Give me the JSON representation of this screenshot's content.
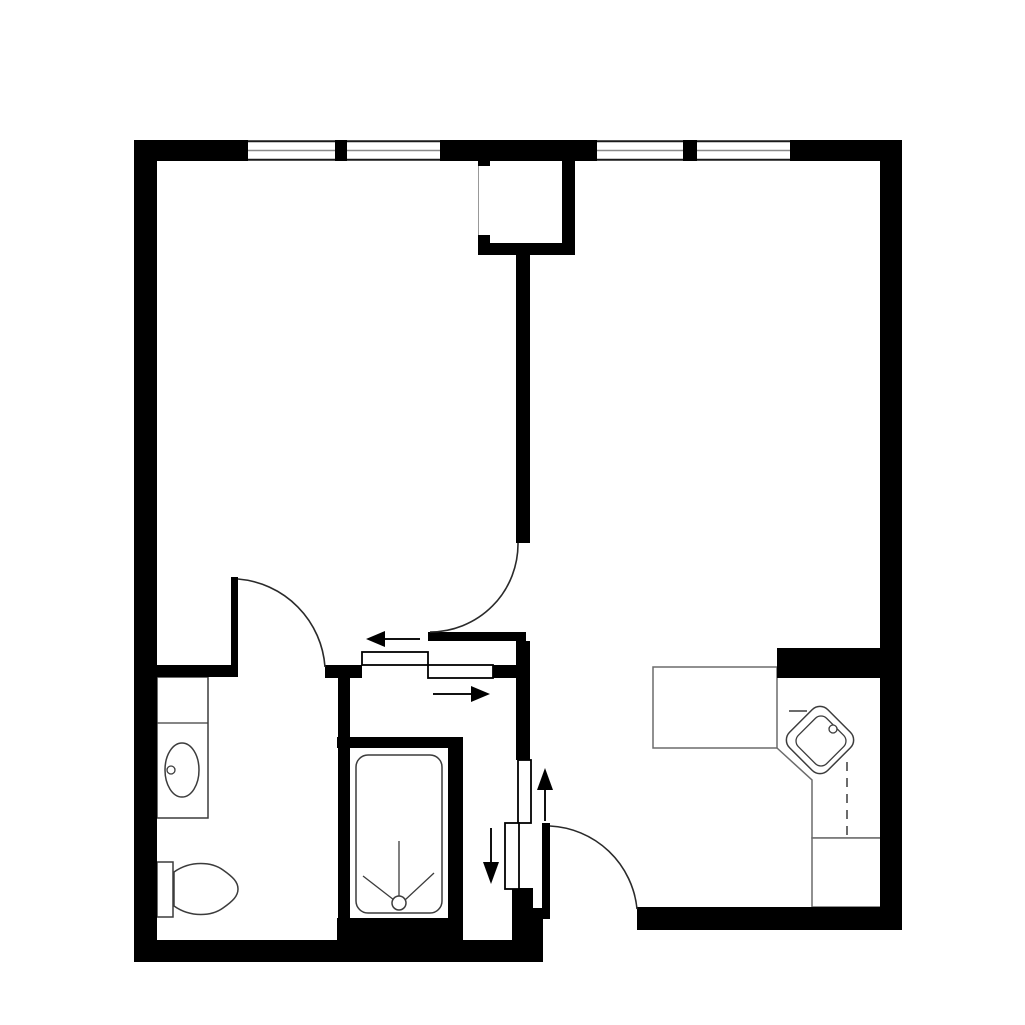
{
  "canvas": {
    "w": 1025,
    "h": 1025,
    "bg": "#ffffff"
  },
  "palette": {
    "wall": "#000000",
    "fixture": "#3c3c3c",
    "counter": "#6b6b6b",
    "window_mid": "#8a8a8a",
    "window_edge": "#1a1a1a",
    "arc": "#2a2a2a",
    "arrow": "#111111",
    "shaft_line": "#999999",
    "floor": "#ffffff"
  },
  "walls": [
    {
      "n": "top-wall-left",
      "x": 134,
      "y": 140,
      "w": 114,
      "h": 21
    },
    {
      "n": "window-mullion-1",
      "x": 335,
      "y": 140,
      "w": 12,
      "h": 21
    },
    {
      "n": "top-wall-center",
      "x": 440,
      "y": 140,
      "w": 157,
      "h": 21
    },
    {
      "n": "window-mullion-2",
      "x": 683,
      "y": 140,
      "w": 14,
      "h": 21
    },
    {
      "n": "top-wall-right",
      "x": 790,
      "y": 140,
      "w": 112,
      "h": 21
    },
    {
      "n": "left-wall",
      "x": 134,
      "y": 140,
      "w": 23,
      "h": 822
    },
    {
      "n": "right-wall",
      "x": 880,
      "y": 140,
      "w": 22,
      "h": 790
    },
    {
      "n": "shaft-right-wall",
      "x": 562,
      "y": 158,
      "w": 13,
      "h": 97
    },
    {
      "n": "shaft-bottom-wall",
      "x": 478,
      "y": 243,
      "w": 97,
      "h": 12
    },
    {
      "n": "shaft-notch-top",
      "x": 478,
      "y": 158,
      "w": 12,
      "h": 8
    },
    {
      "n": "shaft-notch-bottom",
      "x": 478,
      "y": 235,
      "w": 12,
      "h": 8
    },
    {
      "n": "room-divider-wall",
      "x": 516,
      "y": 255,
      "w": 14,
      "h": 288
    },
    {
      "n": "hall-top-wall",
      "x": 428,
      "y": 632,
      "w": 98,
      "h": 9
    },
    {
      "n": "hall-vertical-wall",
      "x": 516,
      "y": 641,
      "w": 14,
      "h": 119
    },
    {
      "n": "bath-top-wall",
      "x": 134,
      "y": 665,
      "w": 98,
      "h": 12
    },
    {
      "n": "bath-door-jamb-wall",
      "x": 325,
      "y": 665,
      "w": 37,
      "h": 13
    },
    {
      "n": "slide-door-right-wall",
      "x": 493,
      "y": 665,
      "w": 23,
      "h": 13
    },
    {
      "n": "bath-right-wall",
      "x": 338,
      "y": 677,
      "w": 12,
      "h": 62
    },
    {
      "n": "shower-top-wall",
      "x": 337,
      "y": 737,
      "w": 126,
      "h": 11
    },
    {
      "n": "shower-left-wall",
      "x": 338,
      "y": 748,
      "w": 12,
      "h": 192
    },
    {
      "n": "shower-right-wall",
      "x": 448,
      "y": 748,
      "w": 15,
      "h": 175
    },
    {
      "n": "shower-bottom-wall",
      "x": 337,
      "y": 918,
      "w": 126,
      "h": 24
    },
    {
      "n": "bottom-wall-left",
      "x": 134,
      "y": 940,
      "w": 409,
      "h": 22
    },
    {
      "n": "entry-step-wall-a",
      "x": 512,
      "y": 888,
      "w": 21,
      "h": 22
    },
    {
      "n": "entry-step-wall-b",
      "x": 512,
      "y": 908,
      "w": 31,
      "h": 34
    },
    {
      "n": "bottom-wall-right",
      "x": 637,
      "y": 907,
      "w": 265,
      "h": 23
    },
    {
      "n": "kitchen-wall-stub",
      "x": 777,
      "y": 648,
      "w": 105,
      "h": 30
    },
    {
      "n": "bath-door-leaf",
      "x": 231,
      "y": 577,
      "w": 7,
      "h": 100
    },
    {
      "n": "entry-door-leaf",
      "x": 542,
      "y": 823,
      "w": 8,
      "h": 96
    }
  ],
  "windows": [
    {
      "n": "window-1",
      "x": 248,
      "y": 140,
      "w": 87,
      "h": 21
    },
    {
      "n": "window-2",
      "x": 347,
      "y": 140,
      "w": 93,
      "h": 21
    },
    {
      "n": "window-3",
      "x": 597,
      "y": 140,
      "w": 86,
      "h": 21
    },
    {
      "n": "window-4",
      "x": 697,
      "y": 140,
      "w": 93,
      "h": 21
    }
  ],
  "sliding_panels": [
    {
      "n": "slide-panel-upper",
      "x": 362,
      "y": 652,
      "w": 66,
      "h": 13
    },
    {
      "n": "slide-panel-lower",
      "x": 428,
      "y": 665,
      "w": 65,
      "h": 13
    },
    {
      "n": "slide-panel-vert-right",
      "x": 518,
      "y": 760,
      "w": 13,
      "h": 63
    },
    {
      "n": "slide-panel-vert-left",
      "x": 505,
      "y": 823,
      "w": 14,
      "h": 66
    }
  ],
  "door_arcs": [
    {
      "n": "center-door-swing-arc",
      "d": "M518,543 A88,88 0 0 1 430,632"
    },
    {
      "n": "bath-door-swing-arc",
      "d": "M238,579 A95,95 0 0 1 325,667"
    },
    {
      "n": "entry-door-swing-arc",
      "d": "M550,826 A92,92 0 0 1 637,909"
    }
  ],
  "arrows": [
    {
      "n": "slide-arrow-left",
      "line": [
        420,
        639,
        384,
        639
      ],
      "head": "366,639 385,631 385,647"
    },
    {
      "n": "slide-arrow-right",
      "line": [
        433,
        694,
        471,
        694
      ],
      "head": "490,694 471,686 471,702"
    },
    {
      "n": "slide-arrow-up",
      "line": [
        545,
        821,
        545,
        789
      ],
      "head": "545,768 537,790 553,790"
    },
    {
      "n": "slide-arrow-down",
      "line": [
        491,
        828,
        491,
        862
      ],
      "head": "491,884 483,862 499,862"
    }
  ],
  "fixtures": [
    {
      "t": "line",
      "n": "shaft-inner-line",
      "x1": 478.5,
      "y1": 166,
      "x2": 478.5,
      "y2": 235,
      "s": "shaft_line",
      "sw": 1
    },
    {
      "t": "rect",
      "n": "vanity-counter",
      "x": 157,
      "y": 677,
      "w": 51,
      "h": 141,
      "s": "fixture",
      "sw": 1.5,
      "f": "#ffffff"
    },
    {
      "t": "line",
      "n": "vanity-divider-line",
      "x1": 157,
      "y1": 723,
      "x2": 208,
      "y2": 723,
      "s": "fixture",
      "sw": 1.3
    },
    {
      "t": "ellipse",
      "n": "bathroom-sink",
      "cx": 182,
      "cy": 770,
      "rx": 17,
      "ry": 27,
      "s": "fixture",
      "sw": 1.5,
      "f": "#ffffff"
    },
    {
      "t": "circle",
      "n": "bathroom-sink-drain",
      "cx": 171,
      "cy": 770,
      "r": 4,
      "s": "fixture",
      "sw": 1.3,
      "f": "#ffffff"
    },
    {
      "t": "rect",
      "n": "toilet-tank",
      "x": 157,
      "y": 862,
      "w": 16,
      "h": 55,
      "s": "fixture",
      "sw": 1.5,
      "f": "#ffffff"
    },
    {
      "t": "path",
      "n": "toilet-bowl",
      "d": "M174,872 C191,860 212,862 223,870 C233,877 238,882 238,889 C238,896 233,901 223,908 C212,916 191,918 174,906 Z",
      "s": "fixture",
      "sw": 1.5,
      "f": "#ffffff"
    },
    {
      "t": "rect",
      "n": "shower-tray",
      "x": 356,
      "y": 755,
      "w": 86,
      "h": 158,
      "rx": 12,
      "s": "fixture",
      "sw": 1.5,
      "f": "#ffffff"
    },
    {
      "t": "line",
      "n": "shower-drain-line-up",
      "x1": 399,
      "y1": 841,
      "x2": 399,
      "y2": 896,
      "s": "fixture",
      "sw": 1.3
    },
    {
      "t": "line",
      "n": "shower-drain-line-left",
      "x1": 363,
      "y1": 876,
      "x2": 394,
      "y2": 900,
      "s": "fixture",
      "sw": 1.3
    },
    {
      "t": "line",
      "n": "shower-drain-line-right",
      "x1": 434,
      "y1": 873,
      "x2": 405,
      "y2": 900,
      "s": "fixture",
      "sw": 1.3
    },
    {
      "t": "circle",
      "n": "shower-drain",
      "cx": 399,
      "cy": 903,
      "r": 7,
      "s": "fixture",
      "sw": 1.5,
      "f": "#ffffff"
    },
    {
      "t": "rect",
      "n": "kitchen-counter-top",
      "x": 653,
      "y": 667,
      "w": 124,
      "h": 81,
      "s": "counter",
      "sw": 1.5,
      "f": "#ffffff"
    },
    {
      "t": "path",
      "n": "kitchen-counter-corner",
      "d": "M777,748 L812,780 L812,838 L882,838",
      "s": "counter",
      "sw": 1.5,
      "f": "none"
    },
    {
      "t": "rect",
      "n": "kitchen-counter-bottom",
      "x": 812,
      "y": 838,
      "w": 70,
      "h": 69,
      "s": "counter",
      "sw": 1.5,
      "f": "#ffffff"
    },
    {
      "t": "line",
      "n": "kitchen-appliance-dash",
      "x1": 847,
      "y1": 762,
      "x2": 847,
      "y2": 835,
      "s": "fixture",
      "sw": 1.5,
      "dash": "9,7"
    },
    {
      "t": "line",
      "n": "kitchen-faucet-spout",
      "x1": 789,
      "y1": 711,
      "x2": 807,
      "y2": 711,
      "s": "fixture",
      "sw": 1.5
    },
    {
      "t": "rect",
      "n": "kitchen-sink-outer",
      "x": 793,
      "y": 713,
      "w": 54,
      "h": 54,
      "rx": 11,
      "tr": "rotate(45 820 740)",
      "s": "fixture",
      "sw": 1.5,
      "f": "#ffffff"
    },
    {
      "t": "rect",
      "n": "kitchen-sink-inner",
      "x": 801,
      "y": 721,
      "w": 40,
      "h": 40,
      "rx": 8,
      "tr": "rotate(45 821 741)",
      "s": "fixture",
      "sw": 1.3,
      "f": "#ffffff"
    },
    {
      "t": "circle",
      "n": "kitchen-faucet",
      "cx": 833,
      "cy": 729,
      "r": 4,
      "s": "fixture",
      "sw": 1.3,
      "f": "#ffffff"
    }
  ]
}
